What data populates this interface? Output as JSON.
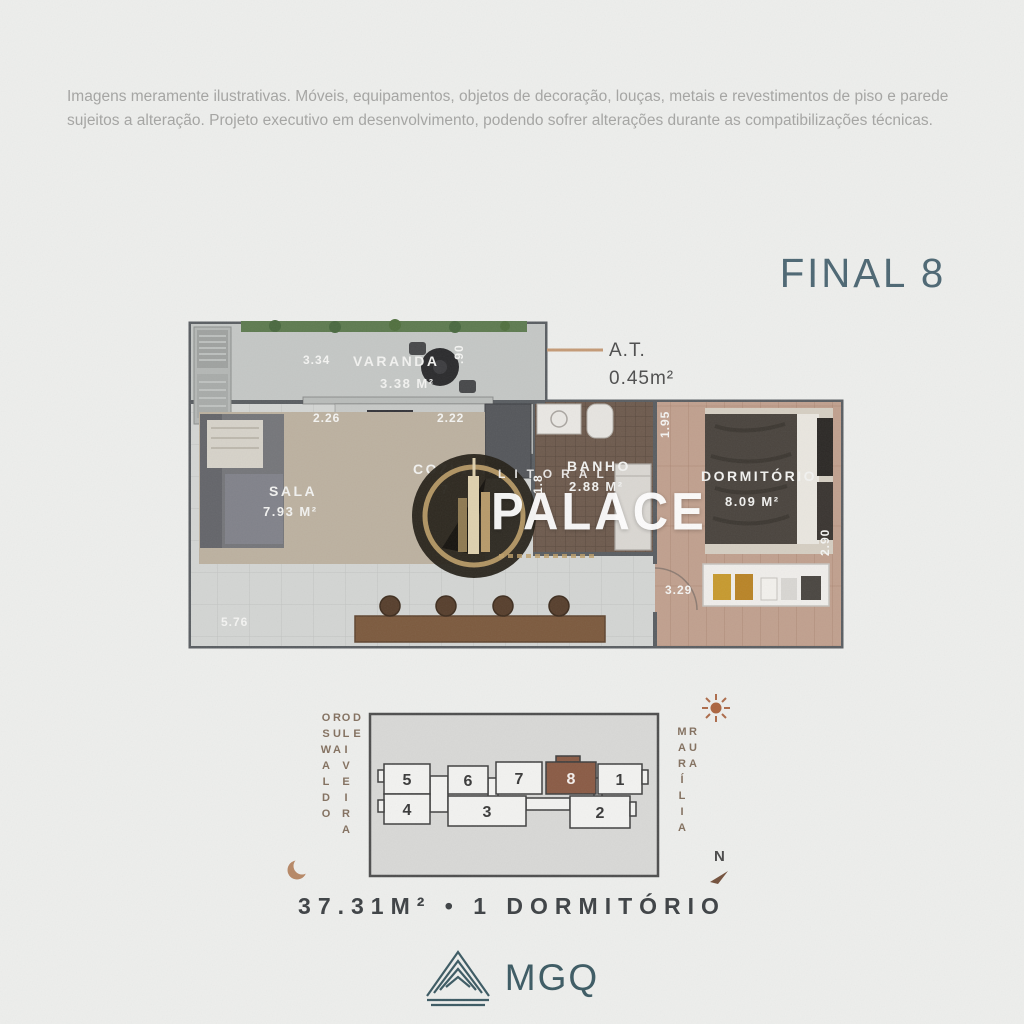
{
  "disclaimer": "Imagens meramente ilustrativas. Móveis, equipamentos, objetos de decoração, louças, metais e revestimentos de piso e parede sujeitos a alteração. Projeto executivo em desenvolvimento, podendo sofrer alterações durante as compatibilizações técnicas.",
  "unit_title": "FINAL 8",
  "summary": "37.31M²  •  1 DORMITÓRIO",
  "floor_plan": {
    "at_label": "A.T.",
    "at_value": "0.45m²",
    "varanda": {
      "name": "VARANDA",
      "area": "3.38 M²",
      "dim_width": "3.34",
      "dim_depth": ".90"
    },
    "sala": {
      "name": "SALA",
      "area": "7.93 M²",
      "dim_top": "2.26",
      "dim_bottom": "5.76"
    },
    "cozinha": {
      "name": "COZINHA",
      "area": "7",
      "dim_top": "2.22"
    },
    "banho": {
      "name": "BANHO",
      "area": "2.88 M²",
      "dim_depth": "1.8"
    },
    "dormitorio": {
      "name": "DORMITÓRIO",
      "area": "8.09 M²",
      "dim_left": "1.95",
      "dim_right": "2.90",
      "dim_bottom": "3.29"
    }
  },
  "key_plan": {
    "street_left_line1": "RUA OSWALDO",
    "street_left_line2": "DE OLIVEIRA",
    "street_right": "RUA MARÍLIA",
    "units": [
      "5",
      "6",
      "7",
      "8",
      "1",
      "4",
      "3",
      "2"
    ],
    "highlighted_unit": "8",
    "compass_n": "N"
  },
  "watermark": {
    "top": "LITORAL",
    "main": "PALACE"
  },
  "developer": {
    "name": "MGQ"
  },
  "colors": {
    "accent_teal": "#4d6773",
    "highlight_unit": "#8a5b45",
    "gold": "#bfa06a"
  }
}
